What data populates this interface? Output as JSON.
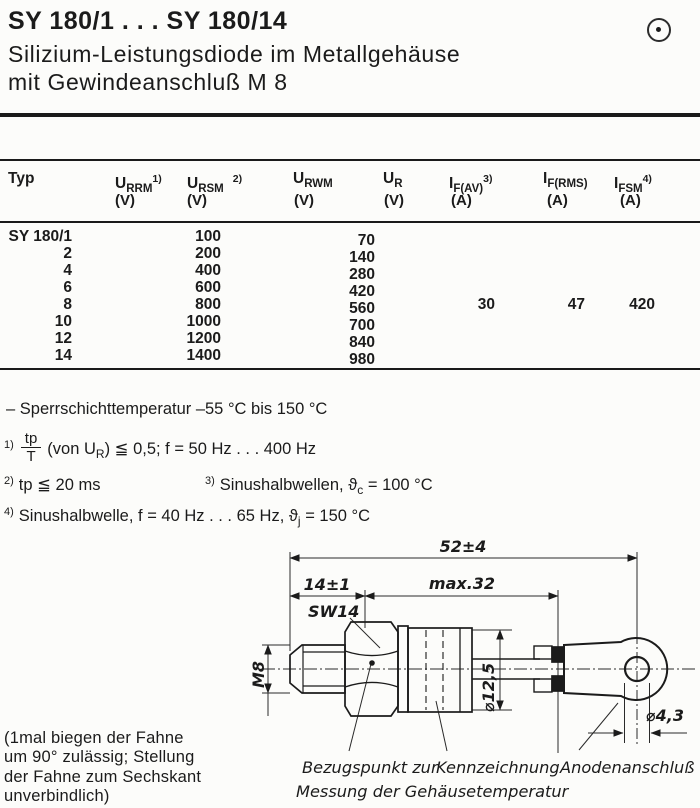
{
  "header": {
    "title": "SY 180/1 . . . SY 180/14",
    "subtitle1": "Silizium-Leistungsdiode im Metallgehäuse",
    "subtitle2": "mit Gewindeanschluß M 8",
    "corner_icon": "circled-dot-icon"
  },
  "colors": {
    "ink": "#1b1b1b",
    "paper": "#fcfcfa"
  },
  "table": {
    "headers": {
      "typ": "Typ",
      "cols": [
        {
          "sym": "U",
          "sub": "RRM",
          "sup": "1)",
          "unit": "(V)"
        },
        {
          "sym": "U",
          "sub": "RSM",
          "sup": "2)",
          "unit": "(V)"
        },
        {
          "sym": "U",
          "sub": "RWM",
          "sup": "",
          "unit": "(V)"
        },
        {
          "sym": "U",
          "sub": "R",
          "sup": "",
          "unit": "(V)"
        },
        {
          "sym": "I",
          "sub": "F(AV)",
          "sup": "3)",
          "unit": "(A)"
        },
        {
          "sym": "I",
          "sub": "F(RMS)",
          "sup": "",
          "unit": "(A)"
        },
        {
          "sym": "I",
          "sub": "FSM",
          "sup": "4)",
          "unit": "(A)"
        }
      ]
    },
    "rows": [
      {
        "typ": "SY 180/1",
        "u_rrm_rsm": "100",
        "u_rwm": "70"
      },
      {
        "typ": "2",
        "u_rrm_rsm": "200",
        "u_rwm": "140"
      },
      {
        "typ": "4",
        "u_rrm_rsm": "400",
        "u_rwm": "280"
      },
      {
        "typ": "6",
        "u_rrm_rsm": "600",
        "u_rwm": "420"
      },
      {
        "typ": "8",
        "u_rrm_rsm": "800",
        "u_rwm": "560"
      },
      {
        "typ": "10",
        "u_rrm_rsm": "1000",
        "u_rwm": "700"
      },
      {
        "typ": "12",
        "u_rrm_rsm": "1200",
        "u_rwm": "840"
      },
      {
        "typ": "14",
        "u_rrm_rsm": "1400",
        "u_rwm": "980"
      }
    ],
    "shared_values": {
      "i_f_av": "30",
      "i_f_rms": "47",
      "i_fsm": "420"
    }
  },
  "notes": {
    "temp_range": "– Sperrschichttemperatur –55 °C bis 150 °C",
    "n1_sup": "1)",
    "n1_frac_top": "tp",
    "n1_frac_bottom": "T",
    "n1_a": "(von U",
    "n1_sub": "R",
    "n1_b": ") ≦ 0,5; f = 50 Hz . . . 400 Hz",
    "n2_sup": "2)",
    "n2_text": "tp ≦ 20 ms",
    "n3_sup": "3)",
    "n3_text": "Sinushalbwellen,",
    "n3_sym": "ϑ",
    "n3_sym_sub": "c",
    "n3_value": "= 100 °C",
    "n4_sup": "4)",
    "n4_text": "Sinushalbwelle, f = 40 Hz . . . 65 Hz,",
    "n4_sym": "ϑ",
    "n4_sym_sub": "j",
    "n4_value": "= 150 °C"
  },
  "diagram": {
    "dim_total": "52±4",
    "dim_stud": "14±1",
    "dim_body": "max.32",
    "wrench_size": "SW14",
    "thread": "M8",
    "dia_body": "⌀12,5",
    "dia_hole": "⌀4,3",
    "label_ref_point_1": "Bezugspunkt zur",
    "label_ref_point_2": "Messung der Gehäusetemperatur",
    "label_marking": "Kennzeichnung",
    "label_anode": "Anodenanschluß"
  },
  "footnote": {
    "line1": "(1mal biegen der Fahne",
    "line2": "um 90° zulässig; Stellung",
    "line3": "der Fahne zum Sechskant",
    "line4": "unverbindlich)"
  }
}
